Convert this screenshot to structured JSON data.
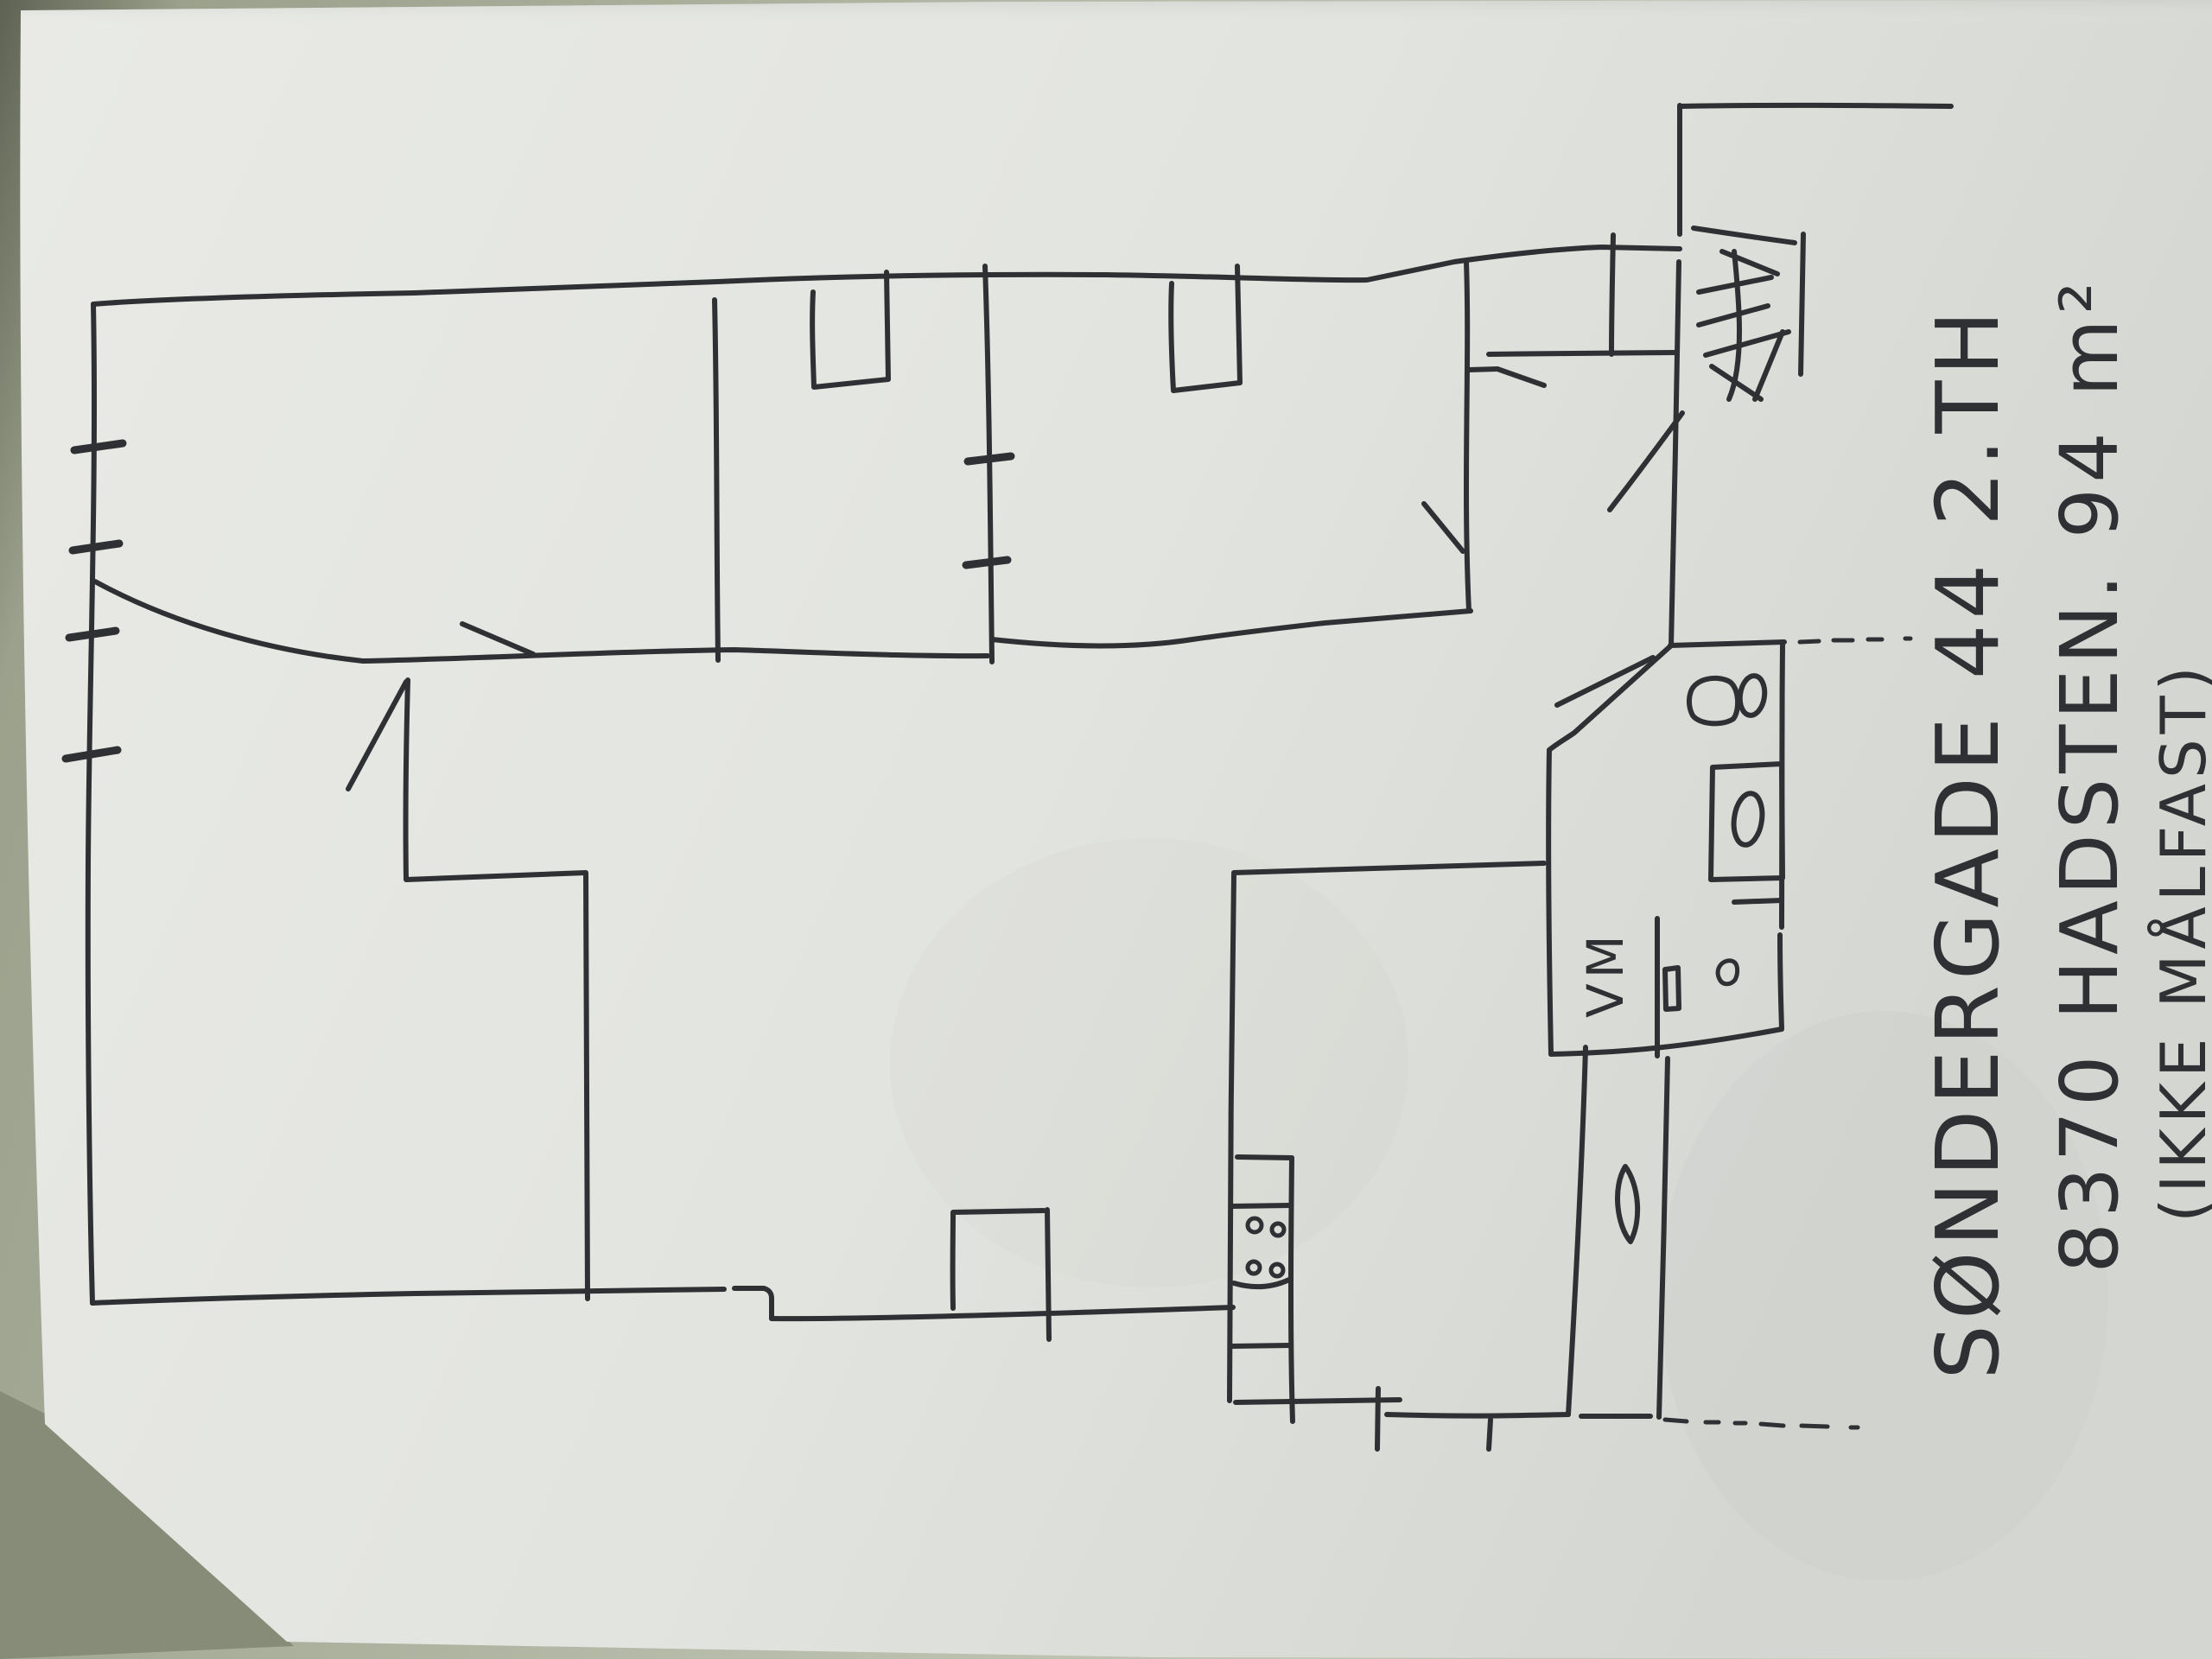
{
  "document": {
    "type": "hand-drawn floor plan sketch on paper",
    "annotation": {
      "line1": "SØNDERGADE 44 2.TH",
      "line2": "8370 HADSTEN. 94 m²",
      "line3": "(IKKE MÅLFAST)"
    },
    "labels": {
      "washing_machine": "VM"
    },
    "colors": {
      "ink": "#2e3033",
      "paper": "#e6e7e3",
      "paper_shade": "#d2d4d0",
      "table": "#9ba18c",
      "table_dark": "#626657",
      "table_light": "#cdd1c3"
    }
  }
}
